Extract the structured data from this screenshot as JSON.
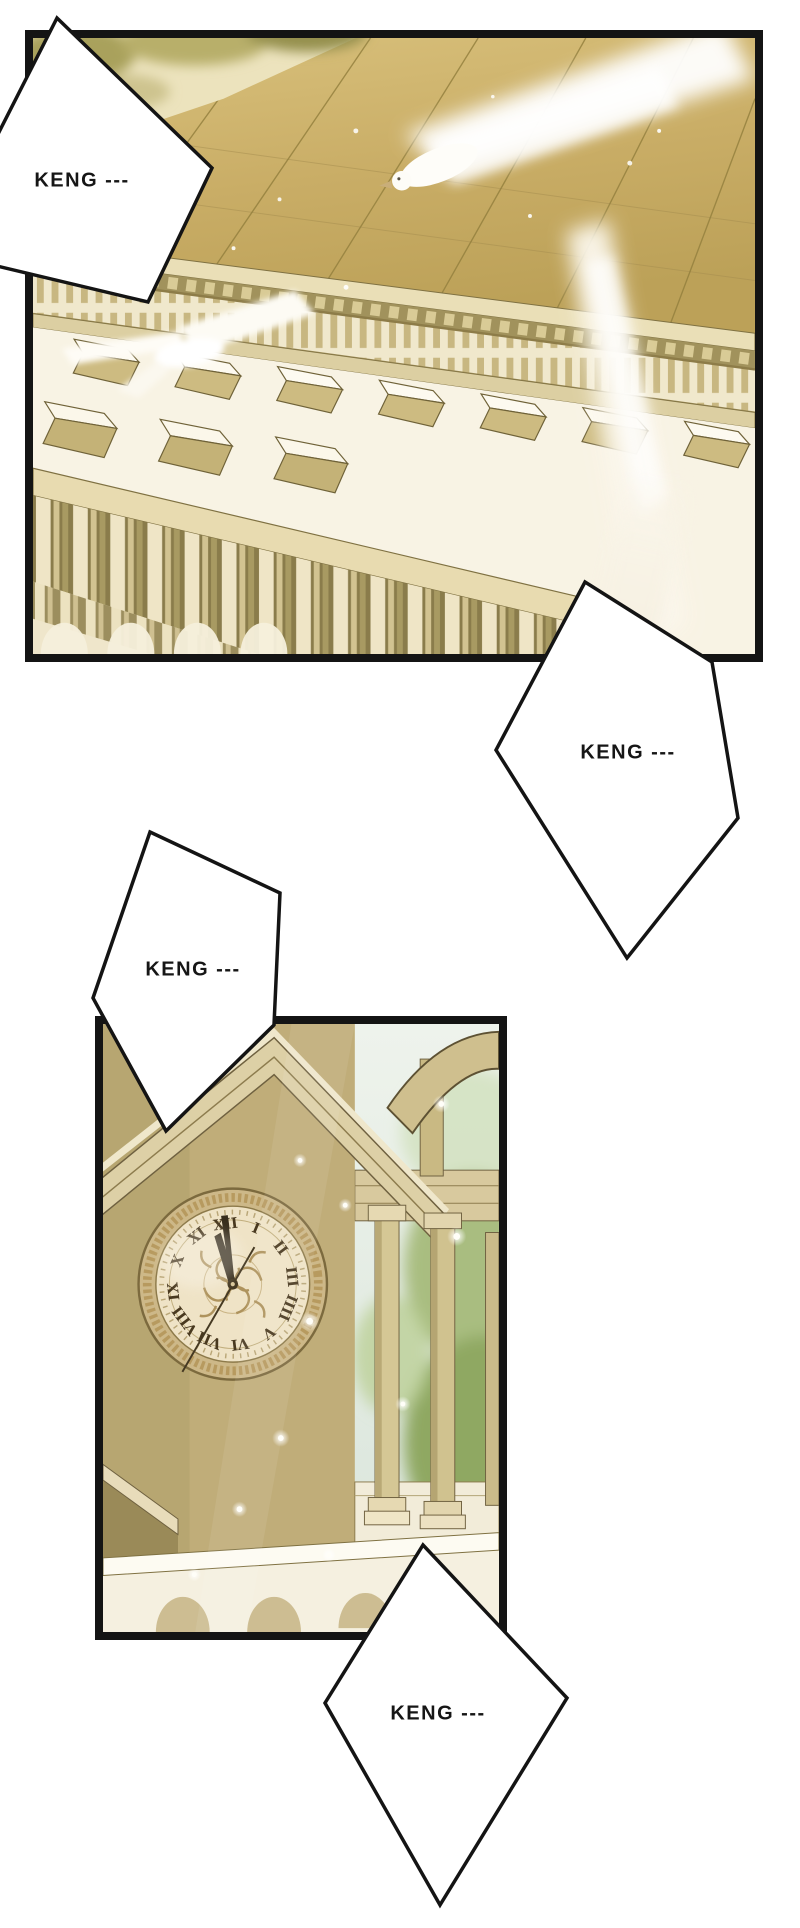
{
  "page": {
    "background": "#ffffff",
    "gutter_color": "#ffffff",
    "panel_border_color": "#141414"
  },
  "sfx": [
    {
      "text": "KENG ---"
    },
    {
      "text": "KENG ---"
    },
    {
      "text": "KENG ---"
    },
    {
      "text": "KENG ---"
    }
  ],
  "panels": [
    {
      "name": "palace-aerial-view",
      "palette": {
        "roof_gold": "#c9ad66",
        "cornice_cream": "#eadfb7",
        "wall_white": "#f8f3e4",
        "column_olive": "#8a7c4b",
        "foliage_olive": "#a9a15b",
        "dove_white": "#ffffff"
      }
    },
    {
      "name": "clock-tower-view",
      "clock": {
        "numerals": [
          "XII",
          "I",
          "II",
          "III",
          "IIII",
          "V",
          "VI",
          "VII",
          "VIII",
          "IX",
          "X",
          "XI"
        ],
        "time_shown": "12:00"
      },
      "palette": {
        "wall_tan": "#c0ad79",
        "pediment_light": "#e9dfc0",
        "clock_face": "#efe3c6",
        "numeral_brown": "#49391f",
        "sky_pale": "#e9f0ea",
        "foliage_green": "#8fa862",
        "ledge_white": "#f5f0e0"
      }
    }
  ]
}
